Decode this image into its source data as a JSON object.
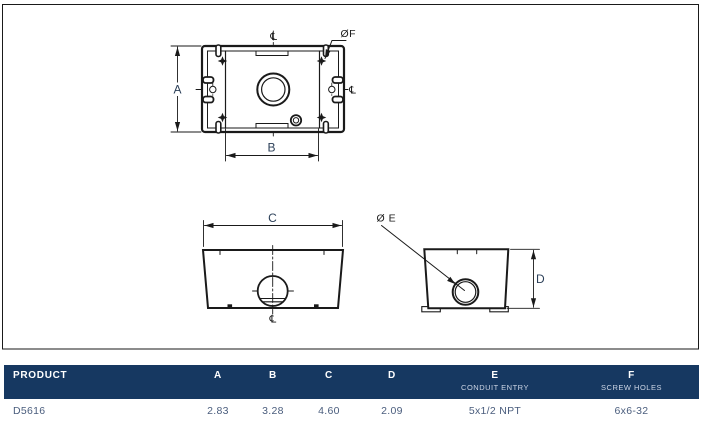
{
  "page": {
    "background": "#ffffff",
    "border_color": "#c9c9c9"
  },
  "drawing": {
    "top_view": {
      "dim_a": "A",
      "dim_b": "B",
      "dia_f": "ØF",
      "centerline_top": "℄",
      "centerline_right": "℄"
    },
    "front_view": {
      "dim_c": "C",
      "centerline_bottom": "℄"
    },
    "side_view": {
      "dim_d": "D",
      "dia_e": "Ø E"
    }
  },
  "table": {
    "header_bg": "#163861",
    "header_text_color": "#ffffff",
    "row_text_color": "#4a5d7d",
    "columns": [
      {
        "label": "PRODUCT",
        "sub": ""
      },
      {
        "label": "A",
        "sub": ""
      },
      {
        "label": "B",
        "sub": ""
      },
      {
        "label": "C",
        "sub": ""
      },
      {
        "label": "D",
        "sub": ""
      },
      {
        "label": "E",
        "sub": "CONDUIT ENTRY"
      },
      {
        "label": "F",
        "sub": "SCREW HOLES"
      }
    ],
    "row": {
      "product": "D5616",
      "a": "2.83",
      "b": "3.28",
      "c": "4.60",
      "d": "2.09",
      "e": "5x1/2 NPT",
      "f": "6x6-32"
    }
  }
}
